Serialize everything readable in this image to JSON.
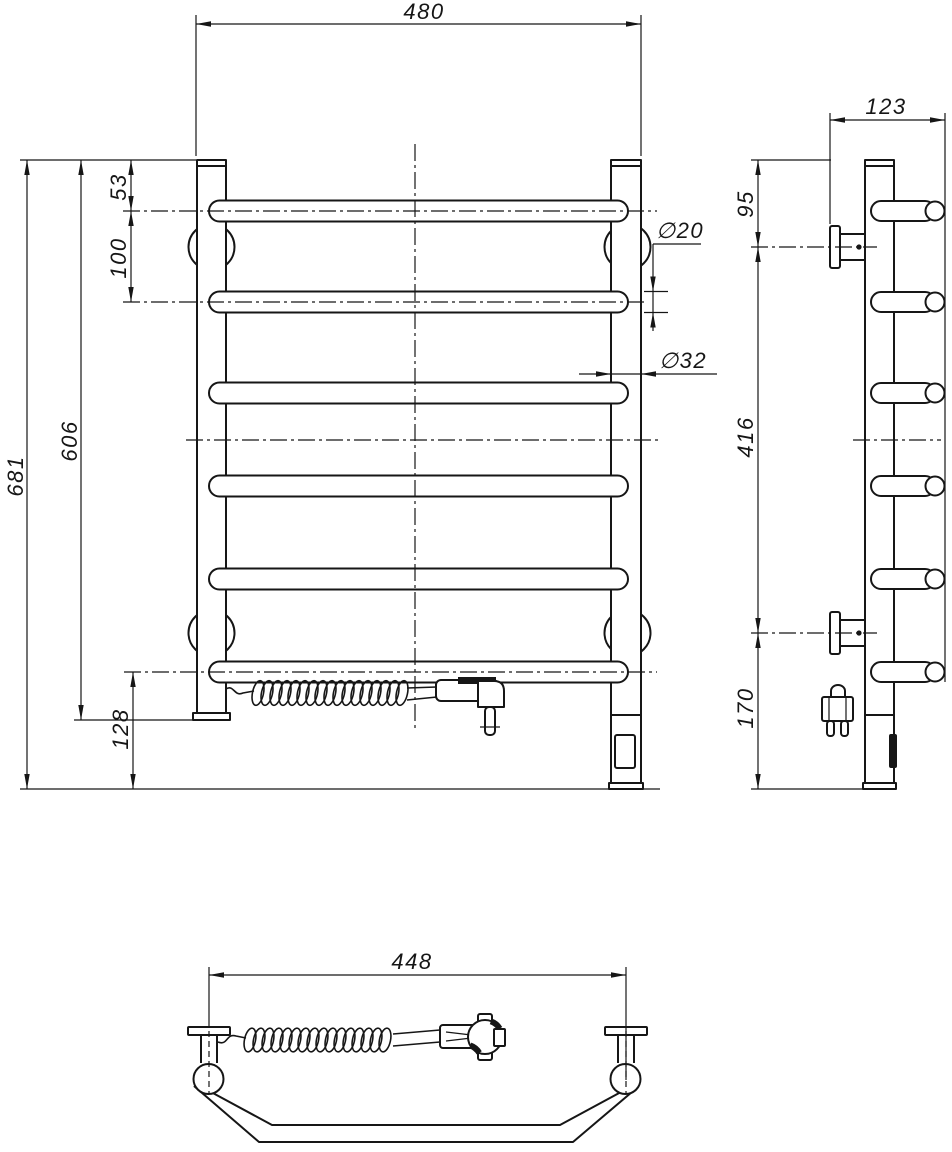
{
  "drawing": {
    "units": "mm",
    "colors": {
      "ink": "#161616"
    },
    "dims": {
      "front": {
        "width": "480",
        "height": "681",
        "rail_height": "606",
        "top_offset": "53",
        "bar_pitch": "100",
        "bottom_offset": "128",
        "bar_dia": "∅20",
        "rail_dia": "∅32"
      },
      "side": {
        "depth": "123",
        "top_to_bracket": "95",
        "bracket_pitch": "416",
        "bracket_to_bottom": "170"
      },
      "bottom": {
        "mount_width": "448"
      }
    }
  }
}
